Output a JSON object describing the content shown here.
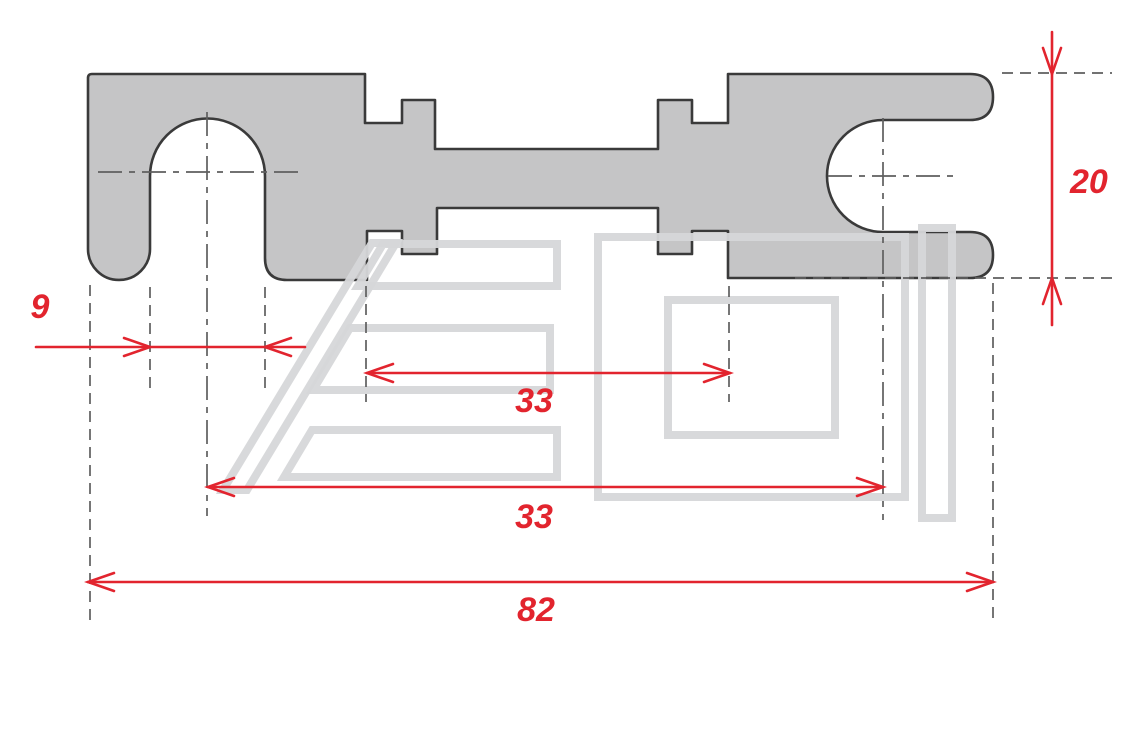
{
  "drawing": {
    "type": "technical-dimension-drawing",
    "subject": "flat fuse strip / terminal link, top view",
    "background_color": "#ffffff",
    "part_fill_color": "#c5c5c6",
    "part_outline_color": "#3a3a3a",
    "dimension_color": "#e2242e",
    "extension_line_color": "#5f5f5f",
    "watermark_color": "#d6d7d9",
    "dimensions": {
      "slot_width": "9",
      "body_gap": "33",
      "center_distance": "33",
      "overall_length": "82",
      "end_width": "20"
    }
  }
}
